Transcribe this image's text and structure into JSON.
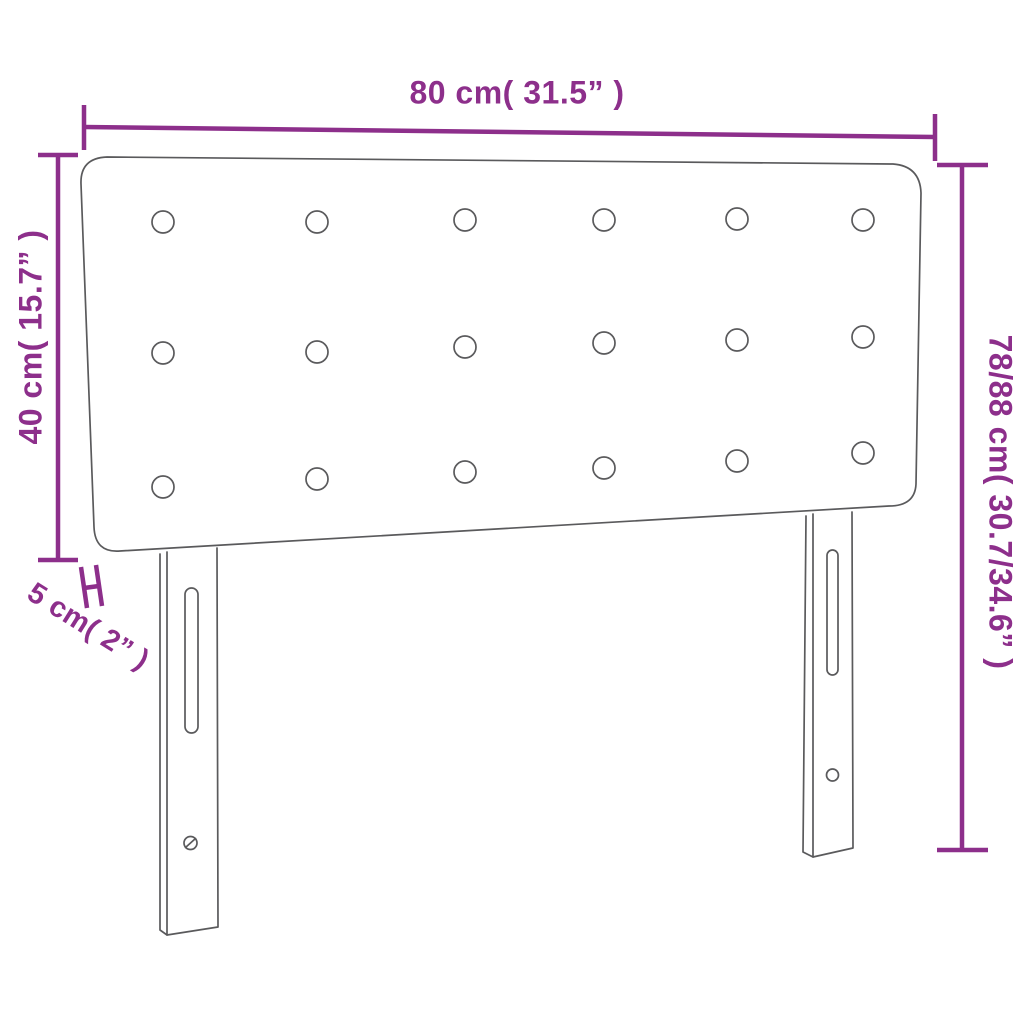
{
  "colors": {
    "accent": "#8d2f8b",
    "line": "#5a5a5c",
    "background": "#ffffff"
  },
  "labels": {
    "width": "80 cm( 31.5” )",
    "headboard_height": "40 cm( 15.7” )",
    "total_height": "78/88 cm( 30.7/34.6” )",
    "thickness": "5 cm( 2” )"
  }
}
